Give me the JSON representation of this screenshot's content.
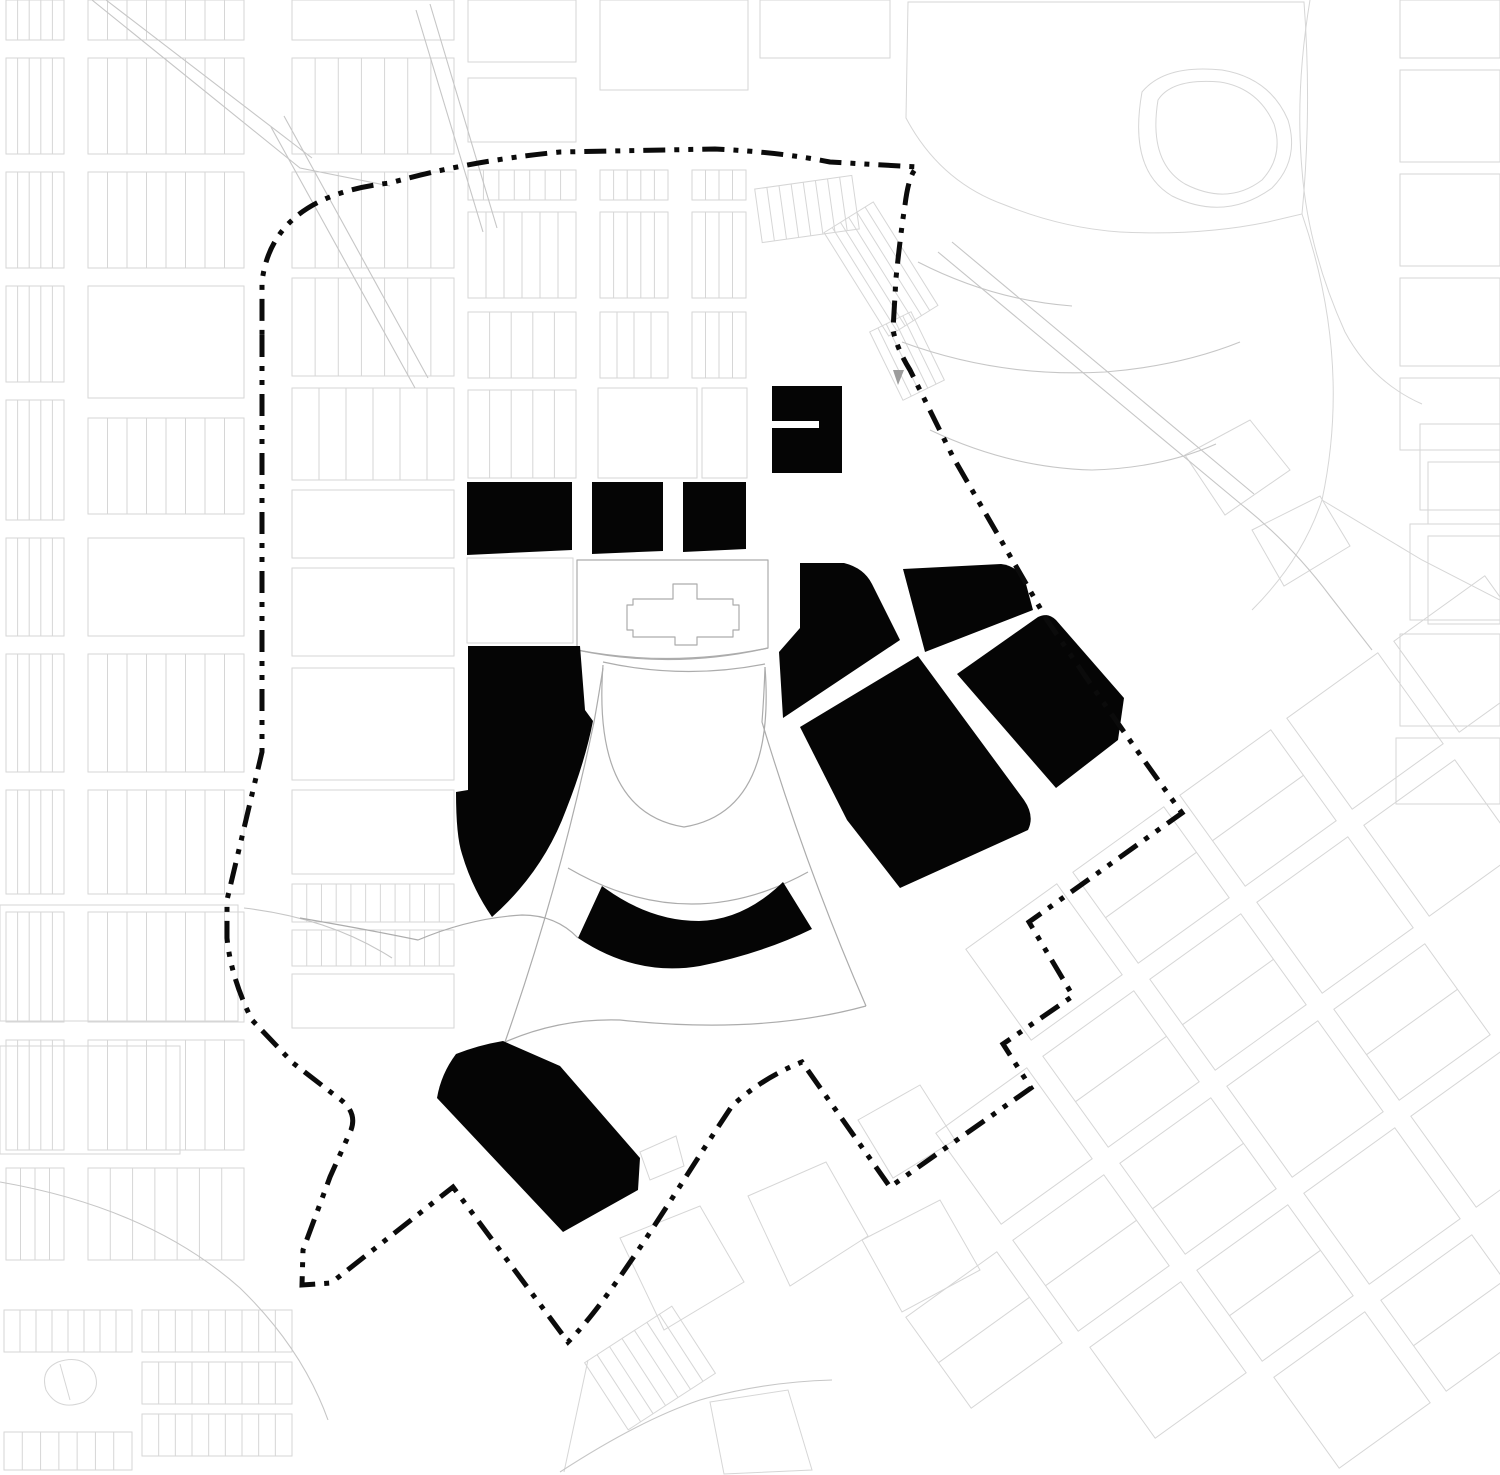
{
  "meta": {
    "title": "Figure-ground urban site plan with dashed project boundary",
    "width": 1500,
    "height": 1475
  },
  "colors": {
    "background": "#ffffff",
    "parcel_line": "#d6d6d6",
    "road_line": "#c6c6c6",
    "landmark_line": "#acacac",
    "building_fill": "#050505",
    "boundary_color": "#0b0b0b",
    "marker_fill": "#9c9c9c"
  },
  "boundary": {
    "dash": "22 9 5 9 5 9",
    "width": 5,
    "path": "M262,335 L262,752 Q246,820 227,900 L227,938 Q231,978 252,1020 L293,1063 L337,1097 Q358,1111 351,1130 L330,1177 L303,1250 L302,1285 L331,1283 L453,1187 L568,1342 C615,1295 682,1180 732,1106 Q762,1078 802,1062 L890,1187 L1031,1088 L1003,1044 L1073,996 L1029,922 L1182,813 Q1122,731 1047,620 L953,457 L910,370 Q897,349 893,330 L896,278 Q901,230 905,205 Q909,172 918,167 L830,162 Q780,152 715,149 L560,152 Q468,161 390,183 Q272,196 262,282 Z"
  },
  "buildings": [
    {
      "id": "north-notched-block",
      "path": "M772,386 L842,386 L842,473 L772,473 L772,428 L819,428 L819,421 L772,421 Z"
    },
    {
      "id": "west-row-block",
      "path": "M467,482 L572,482 L572,550 L467,555 Z"
    },
    {
      "id": "center-row-block",
      "path": "M592,482 L663,482 L663,551 L592,554 Z"
    },
    {
      "id": "east-row-block",
      "path": "M683,482 L746,482 L746,549 L683,552 Z"
    },
    {
      "id": "west-superblock",
      "path": "M468,646 L580,646 L585,710 L593,721 Q585,762 566,810 Q543,872 492,917 Q472,888 462,854 Q456,836 456,792 L468,790 Z"
    },
    {
      "id": "crescent-arc-building",
      "path": "M578,938 Q636,977 700,966 Q763,953 812,929 L783,882 Q744,920 699,921 Q649,921 602,886 Z"
    },
    {
      "id": "northeast-corner-block",
      "path": "M800,563 L844,563 Q864,568 872,584 L900,640 L783,718 L779,652 L800,628 Z"
    },
    {
      "id": "northeast-top-block",
      "path": "M903,569 L1001,564 Q1019,566 1026,584 L1033,610 L925,652 Z"
    },
    {
      "id": "central-diamond-superblock",
      "path": "M800,727 L918,656 L1024,800 Q1035,816 1028,830 L900,888 L847,820 Z"
    },
    {
      "id": "east-parallelogram-block",
      "path": "M957,674 L1038,617 Q1048,612 1056,620 L1124,698 L1118,740 L1056,788 Z"
    },
    {
      "id": "south-rounded-block",
      "path": "M456,1054 Q479,1045 503,1041 L560,1066 L640,1158 L638,1190 L563,1232 L437,1098 Q441,1074 456,1054 Z"
    }
  ],
  "landmarks": [
    {
      "id": "parliament-block-outline",
      "path": "M577,560 L768,560 L768,648 Q672,668 577,650 Z"
    },
    {
      "id": "cross-building-footprint",
      "path": "M673,584 L697,584 L697,599 L733,599 L733,605 L739,605 L739,630 L733,630 L733,637 L697,637 L697,645 L675,645 L675,637 L633,637 L633,630 L627,630 L627,605 L633,605 L633,599 L673,599 Z"
    },
    {
      "id": "forecourt-moat-arc-1",
      "path": "M577,650 Q672,670 768,648"
    },
    {
      "id": "forecourt-moat-arc-2",
      "path": "M603,662 Q684,680 765,664"
    },
    {
      "id": "semicircular-bowl",
      "path": "M603,665 Q592,812 684,827 Q776,812 765,667"
    },
    {
      "id": "fan-radial-west",
      "path": "M603,668 Q598,700 594,722 Q560,885 505,1042"
    },
    {
      "id": "fan-radial-east",
      "path": "M765,667 Q764,696 762,722 Q806,868 866,1006"
    },
    {
      "id": "fan-outer-arc",
      "path": "M505,1042 Q560,1018 620,1020 Q760,1035 866,1006"
    },
    {
      "id": "fan-inner-arc",
      "path": "M568,868 Q688,938 808,872"
    },
    {
      "id": "fan-tip-road",
      "path": "M300,918 Q370,930 418,940 Q470,918 522,915 Q556,915 578,938"
    }
  ],
  "marker": {
    "id": "triangle-marker",
    "path": "M893,370 L904,370 L898,385 Z"
  },
  "background": {
    "strip_blocks": [
      {
        "x": 6,
        "y": 0,
        "w": 58,
        "h": 40,
        "n": 4
      },
      {
        "x": 6,
        "y": 58,
        "w": 58,
        "h": 96,
        "n": 4
      },
      {
        "x": 6,
        "y": 172,
        "w": 58,
        "h": 96,
        "n": 4
      },
      {
        "x": 6,
        "y": 286,
        "w": 58,
        "h": 96,
        "n": 4
      },
      {
        "x": 6,
        "y": 400,
        "w": 58,
        "h": 120,
        "n": 4
      },
      {
        "x": 6,
        "y": 538,
        "w": 58,
        "h": 98,
        "n": 4
      },
      {
        "x": 6,
        "y": 654,
        "w": 58,
        "h": 118,
        "n": 4
      },
      {
        "x": 6,
        "y": 790,
        "w": 58,
        "h": 104,
        "n": 4
      },
      {
        "x": 6,
        "y": 912,
        "w": 58,
        "h": 110,
        "n": 4
      },
      {
        "x": 6,
        "y": 1040,
        "w": 58,
        "h": 110,
        "n": 4
      },
      {
        "x": 6,
        "y": 1168,
        "w": 58,
        "h": 92,
        "n": 3
      },
      {
        "x": 88,
        "y": 0,
        "w": 156,
        "h": 40,
        "n": 7
      },
      {
        "x": 88,
        "y": 58,
        "w": 156,
        "h": 96,
        "n": 7
      },
      {
        "x": 88,
        "y": 172,
        "w": 156,
        "h": 96,
        "n": 7
      },
      {
        "x": 88,
        "y": 286,
        "w": 156,
        "h": 112,
        "n": 0
      },
      {
        "x": 88,
        "y": 418,
        "w": 156,
        "h": 96,
        "n": 7
      },
      {
        "x": 88,
        "y": 538,
        "w": 156,
        "h": 98,
        "n": 0
      },
      {
        "x": 88,
        "y": 654,
        "w": 156,
        "h": 118,
        "n": 7
      },
      {
        "x": 88,
        "y": 790,
        "w": 156,
        "h": 104,
        "n": 7
      },
      {
        "x": 88,
        "y": 912,
        "w": 156,
        "h": 110,
        "n": 7
      },
      {
        "x": 88,
        "y": 1040,
        "w": 156,
        "h": 110,
        "n": 7
      },
      {
        "x": 88,
        "y": 1168,
        "w": 156,
        "h": 92,
        "n": 6
      },
      {
        "x": 292,
        "y": 0,
        "w": 162,
        "h": 40,
        "n": 0
      },
      {
        "x": 292,
        "y": 58,
        "w": 162,
        "h": 96,
        "n": 6
      },
      {
        "x": 292,
        "y": 172,
        "w": 162,
        "h": 96,
        "n": 6
      },
      {
        "x": 292,
        "y": 278,
        "w": 162,
        "h": 98,
        "n": 6
      },
      {
        "x": 292,
        "y": 388,
        "w": 162,
        "h": 92,
        "n": 5
      },
      {
        "x": 292,
        "y": 490,
        "w": 162,
        "h": 68,
        "n": 0
      },
      {
        "x": 292,
        "y": 568,
        "w": 162,
        "h": 88,
        "n": 0
      },
      {
        "x": 292,
        "y": 668,
        "w": 162,
        "h": 112,
        "n": 0
      },
      {
        "x": 292,
        "y": 790,
        "w": 162,
        "h": 84,
        "n": 0
      },
      {
        "x": 292,
        "y": 884,
        "w": 162,
        "h": 38,
        "n": 10
      },
      {
        "x": 292,
        "y": 930,
        "w": 162,
        "h": 36,
        "n": 10
      },
      {
        "x": 292,
        "y": 974,
        "w": 162,
        "h": 54,
        "n": 0
      },
      {
        "x": 468,
        "y": 170,
        "w": 108,
        "h": 30,
        "n": 6
      },
      {
        "x": 468,
        "y": 212,
        "w": 108,
        "h": 86,
        "n": 5
      },
      {
        "x": 468,
        "y": 312,
        "w": 108,
        "h": 66,
        "n": 4
      },
      {
        "x": 468,
        "y": 390,
        "w": 108,
        "h": 88,
        "n": 4
      },
      {
        "x": 600,
        "y": 170,
        "w": 68,
        "h": 30,
        "n": 4
      },
      {
        "x": 600,
        "y": 212,
        "w": 68,
        "h": 86,
        "n": 4
      },
      {
        "x": 600,
        "y": 312,
        "w": 68,
        "h": 66,
        "n": 3
      },
      {
        "x": 692,
        "y": 170,
        "w": 54,
        "h": 30,
        "n": 3
      },
      {
        "x": 692,
        "y": 212,
        "w": 54,
        "h": 86,
        "n": 3
      },
      {
        "x": 692,
        "y": 312,
        "w": 54,
        "h": 66,
        "n": 3
      },
      {
        "x": 758,
        "y": 182,
        "w": 98,
        "h": 54,
        "n": 7,
        "rot": -8
      },
      {
        "x": 852,
        "y": 208,
        "w": 58,
        "h": 122,
        "n": 5,
        "rot": -32
      },
      {
        "x": 884,
        "y": 318,
        "w": 46,
        "h": 76,
        "n": 4,
        "rot": -26
      },
      {
        "x": 598,
        "y": 1328,
        "w": 104,
        "h": 80,
        "n": 6,
        "rot": -33
      },
      {
        "x": 4,
        "y": 1310,
        "w": 128,
        "h": 42,
        "n": 7
      },
      {
        "x": 142,
        "y": 1310,
        "w": 150,
        "h": 42,
        "n": 8
      },
      {
        "x": 142,
        "y": 1362,
        "w": 150,
        "h": 42,
        "n": 8
      },
      {
        "x": 142,
        "y": 1414,
        "w": 150,
        "h": 42,
        "n": 8
      },
      {
        "x": 4,
        "y": 1432,
        "w": 128,
        "h": 38,
        "n": 6
      }
    ],
    "plain_rects": [
      [
        468,
        0,
        108,
        62
      ],
      [
        600,
        0,
        148,
        90
      ],
      [
        468,
        78,
        108,
        64
      ],
      [
        760,
        0,
        130,
        58
      ],
      [
        598,
        388,
        99,
        90
      ],
      [
        702,
        388,
        45,
        90
      ],
      [
        467,
        558,
        106,
        85
      ],
      [
        0,
        905,
        238,
        116
      ],
      [
        0,
        1046,
        180,
        108
      ],
      [
        1400,
        0,
        100,
        58
      ],
      [
        1400,
        70,
        100,
        92
      ],
      [
        1400,
        174,
        100,
        92
      ],
      [
        1400,
        278,
        100,
        88
      ],
      [
        1400,
        378,
        100,
        72
      ],
      [
        1428,
        462,
        72,
        62
      ],
      [
        1428,
        536,
        72,
        88
      ],
      [
        1420,
        424,
        80,
        86
      ],
      [
        1410,
        524,
        90,
        96
      ],
      [
        1400,
        634,
        100,
        92
      ],
      [
        1396,
        738,
        104,
        66
      ]
    ],
    "road_paths": [
      "M92,0 L300,168 L390,186",
      "M106,0 L312,158",
      "M430,4 L497,228",
      "M416,10 L483,232",
      "M284,116 L428,378",
      "M271,127 L415,388",
      "M902,342 Q1000,378 1105,372 Q1180,366 1240,342",
      "M918,262 Q992,300 1072,306",
      "M930,430 Q1010,468 1092,470 Q1162,468 1216,444",
      "M938,252 L1242,505",
      "M952,242 L1254,494",
      "M1242,505 Q1292,545 1330,596 L1372,650",
      "M244,908 Q330,918 392,958",
      "M0,1182 Q150,1208 240,1288 Q302,1348 328,1420",
      "M560,1472 Q640,1420 700,1400 Q762,1382 832,1380"
    ],
    "parcel_paths": [
      "M908,2 L906,118 Q940,182 1005,205 Q1062,228 1120,232 Q1200,236 1268,222 L1302,214 Q1312,110 1304,2 Z",
      "M1142,92 Q1128,170 1172,196 Q1225,222 1272,188 Q1300,160 1288,120 Q1270,78 1222,70 Q1165,64 1142,92 Z",
      "M1158,100 Q1148,162 1185,184 Q1228,206 1262,180 Q1284,156 1274,124 Q1258,88 1220,82 Q1172,78 1158,100 Z",
      "M1310,0 Q1295,90 1302,170 Q1308,250 1345,332 Q1372,382 1422,404",
      "M1302,214 Q1352,360 1322,500 Q1302,560 1252,610",
      "M1322,500 L1422,560 L1500,600",
      "M1185,455 L1250,420 L1290,470 L1225,515 Z",
      "M1252,530 L1320,496 L1350,546 L1284,586 Z",
      "M620,1238 L700,1206 L744,1282 L664,1330 Z",
      "M748,1196 L826,1162 L868,1236 L790,1286 Z",
      "M640,1152 L676,1136 L684,1166 L650,1180 Z",
      "M588,1360 L564,1472",
      "M710,1402 L788,1390 L812,1470 L724,1474 Z",
      "M862,1240 L940,1200 L980,1270 L902,1312 Z",
      "M858,1120 L920,1085 L955,1140 L893,1178 Z",
      "M46,1390 Q40,1370 58,1362 Q82,1354 94,1372 Q102,1390 84,1402 Q58,1412 46,1390 Z",
      "M60,1364 L70,1400"
    ],
    "rot_grid": {
      "angle": -35.7,
      "size": 112,
      "centers": [
        [
          1258,
          808
        ],
        [
          1365,
          731
        ],
        [
          1472,
          654
        ],
        [
          1151,
          885
        ],
        [
          1044,
          962
        ],
        [
          1228,
          992
        ],
        [
          1335,
          915
        ],
        [
          1442,
          838
        ],
        [
          1121,
          1069
        ],
        [
          1198,
          1176
        ],
        [
          1305,
          1099
        ],
        [
          1412,
          1022
        ],
        [
          1014,
          1146
        ],
        [
          1091,
          1253
        ],
        [
          1168,
          1360
        ],
        [
          1275,
          1283
        ],
        [
          1382,
          1206
        ],
        [
          1489,
          1129
        ],
        [
          984,
          1330
        ],
        [
          1352,
          1390
        ],
        [
          1459,
          1313
        ]
      ],
      "sub": [
        1,
        0,
        0,
        1,
        0,
        1,
        0,
        0,
        1,
        1,
        0,
        1,
        0,
        1,
        0,
        1,
        0,
        0,
        1,
        0,
        1
      ]
    }
  }
}
